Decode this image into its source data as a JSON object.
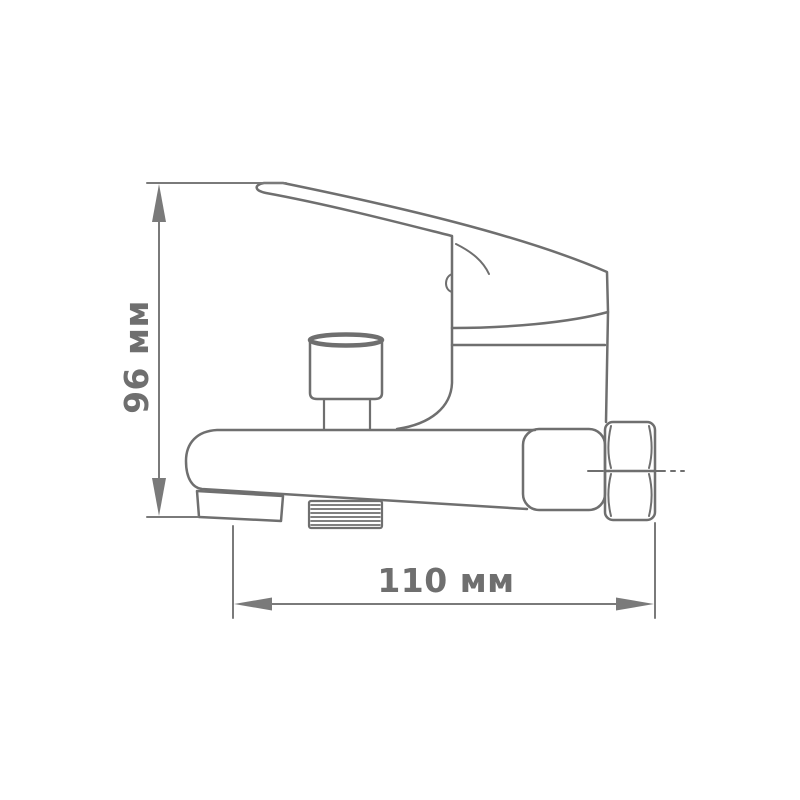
{
  "drawing": {
    "kind": "technical-dimension-drawing",
    "subject": "wall-mounted single-lever bath mixer faucet, side view"
  },
  "dimensions": {
    "height": {
      "label": "96 мм",
      "value": 96,
      "unit": "мм"
    },
    "width": {
      "label": "110 мм",
      "value": 110,
      "unit": "мм"
    }
  },
  "colors": {
    "line": "#6f6f6f",
    "dimension": "#7a7a7a",
    "text": "#6f6f6f",
    "background": "#ffffff"
  }
}
